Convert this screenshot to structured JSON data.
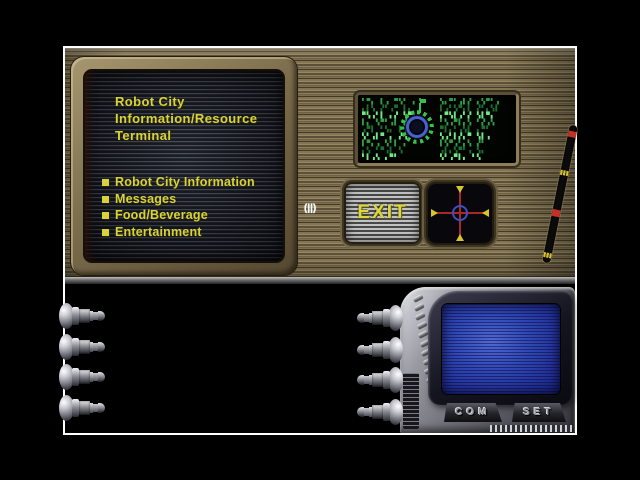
{
  "window": {
    "bg": "#000000",
    "frame_color": "#ffffff"
  },
  "terminal": {
    "title_lines": [
      "Robot City",
      "Information/Resource",
      "Terminal"
    ],
    "menu_items": [
      "Robot City Information",
      "Messages",
      "Food/Beverage",
      "Entertainment"
    ],
    "text_color": "#d9d33b"
  },
  "exit_button": {
    "label": "EXIT"
  },
  "cursor": {
    "glyph": "(||)"
  },
  "device": {
    "com_label": "COM",
    "set_label": "SET"
  },
  "data_screen": {
    "left_lines": [
      "▘▀▖ ▌▗ ▀▚▘ ▖▝",
      "▖▌▚ ▞▘▗▀ ▌▖",
      "▀▚▗▘▌ ▖▞ ▚▀",
      "▌▖ ▚▀▘▗▌ ▞▖",
      "▗▀▌ ▘▚▖ ▌▗▘",
      "▚▘▗▌▀ ▖ ▞▚",
      "▌▀▖▗ ▚▘▌ ▖",
      "▖▚ ▘▀▗▌ ▚",
      "▘▌▗▚ ▖▀▘"
    ],
    "right_lines": [
      "▚▖▀▘▗▌▞ ▖▚▀▘▗",
      "▌▗▘▚▀▖▌ ▞▘▖▚▌",
      "▖▀▚▌▗▘▞ ▚▌▀▖",
      "▘▚▗▀▌▖▚ ▘▞▗▚",
      "▀▌▖▘▗▚▌ ▖▀▘",
      "▚▗▘▌▞▖▀ ▚▌▗",
      "▌▚▀▗▘▖▚ ▞▘",
      "▗▌▖▚▀▘▗ ▚▖",
      "▚▘▗▀▌▖ ▘▚"
    ]
  },
  "colors": {
    "panel_tan": "#7a6c4c",
    "accent_yellow": "#d9d33b",
    "matrix_green": "#2f9e44",
    "crosshair_red": "#a82828",
    "device_screen_blue": "#3048b8"
  }
}
